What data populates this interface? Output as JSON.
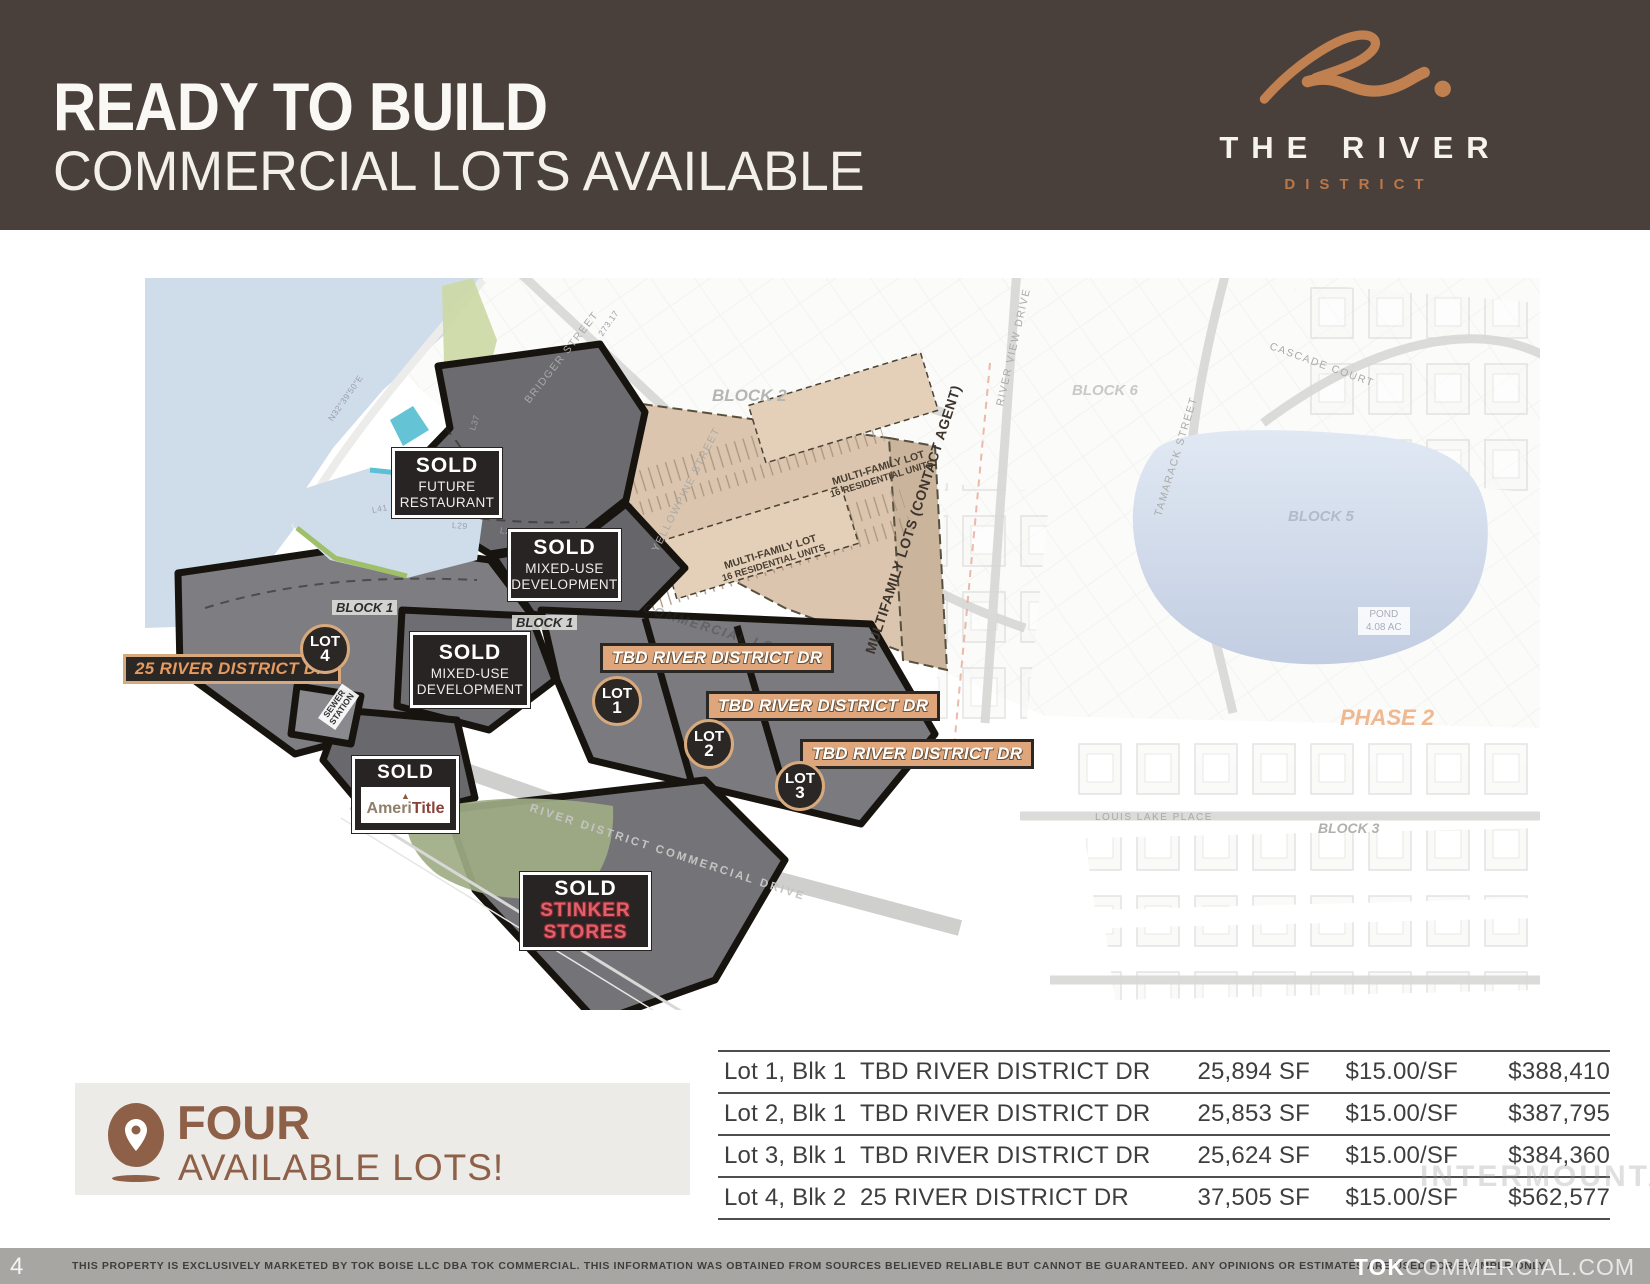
{
  "header": {
    "title_line1": "READY TO BUILD",
    "title_line2": "COMMERCIAL LOTS AVAILABLE",
    "logo_name": "THE RIVER",
    "logo_sub": "DISTRICT"
  },
  "colors": {
    "header_bg": "#493f3b",
    "copper": "#c0804f",
    "tag_tan": "#dfa67c",
    "box_dark": "#282423",
    "water": "#cfdcea",
    "brown_text": "#8d6047",
    "stinker_red": "#e2606a",
    "footer_gray": "#a8a6a3"
  },
  "map": {
    "sold_restaurant": {
      "tag": "SOLD",
      "line1": "FUTURE",
      "line2": "RESTAURANT"
    },
    "sold_mixed_upper": {
      "tag": "SOLD",
      "line1": "MIXED-USE",
      "line2": "DEVELOPMENT"
    },
    "sold_mixed_lower": {
      "tag": "SOLD",
      "line1": "MIXED-USE",
      "line2": "DEVELOPMENT"
    },
    "sold_amerititle": {
      "tag": "SOLD",
      "brand_prefix": "Ameri",
      "brand_suffix": "Title",
      "triangle_icon": "▲"
    },
    "sold_stinker": {
      "tag": "SOLD",
      "line1": "STINKER",
      "line2": "STORES"
    },
    "address_tags": [
      {
        "text": "TBD RIVER DISTRICT DR"
      },
      {
        "text": "TBD RIVER DISTRICT DR"
      },
      {
        "text": "TBD RIVER DISTRICT DR"
      },
      {
        "text": "25 RIVER DISTRICT DR"
      }
    ],
    "lot_badges": [
      {
        "label": "LOT",
        "num": "1"
      },
      {
        "label": "LOT",
        "num": "2"
      },
      {
        "label": "LOT",
        "num": "3"
      },
      {
        "label": "LOT",
        "num": "4"
      }
    ],
    "multifamily": {
      "pads": [
        {
          "line1": "MULTI-FAMILY LOT",
          "line2": "16 RESIDENTIAL UNITS"
        },
        {
          "line1": "MULTI-FAMILY LOT",
          "line2": "16 RESIDENTIAL UNITS"
        }
      ],
      "edge": "MULTIFAMILY LOTS (CONTACT AGENT)"
    },
    "blocks": {
      "block1a": "BLOCK 1",
      "block1b": "BLOCK 1",
      "block2": "BLOCK 2",
      "block3": "BLOCK 3",
      "block5": "BLOCK 5",
      "block6": "BLOCK 6"
    },
    "phase": "PHASE 2",
    "pond_line1": "POND",
    "pond_line2": "4.08 AC",
    "streets": {
      "bridger": "BRIDGER STREET",
      "riverview": "RIVER VIEW DRIVE",
      "tamarack": "TAMARACK STREET",
      "cascade": "CASCADE COURT",
      "louislake": "LOUIS LAKE PLACE",
      "yellowpine": "YELLOWPINE STREET",
      "commercial": "RIVER DISTRICT COMMERCIAL DRIVE",
      "sewer_line1": "SEWER",
      "sewer_line2": "STATION"
    },
    "ghost_label": "COMMERCIAL LOTS",
    "survey": [
      "273.17",
      "N32°39'50\"E",
      "L37",
      "L38",
      "L39",
      "L40",
      "L41",
      "L28",
      "L29"
    ]
  },
  "availability": {
    "headline": "FOUR",
    "subline": "AVAILABLE LOTS!"
  },
  "table": {
    "rows": [
      {
        "lot": "Lot 1, Blk 1",
        "address": "TBD RIVER DISTRICT DR",
        "size": "25,894 SF",
        "rate": "$15.00/SF",
        "price": "$388,410"
      },
      {
        "lot": "Lot 2, Blk 1",
        "address": "TBD RIVER DISTRICT DR",
        "size": "25,853 SF",
        "rate": "$15.00/SF",
        "price": "$387,795"
      },
      {
        "lot": "Lot 3, Blk 1",
        "address": "TBD RIVER DISTRICT DR",
        "size": "25,624 SF",
        "rate": "$15.00/SF",
        "price": "$384,360"
      },
      {
        "lot": "Lot 4, Blk 2",
        "address": "25 RIVER DISTRICT DR",
        "size": "37,505 SF",
        "rate": "$15.00/SF",
        "price": "$562,577"
      }
    ]
  },
  "watermark": "INTERMOUNTAIN",
  "footer": {
    "page_number": "4",
    "disclaimer": "THIS PROPERTY IS EXCLUSIVELY MARKETED BY TOK BOISE LLC DBA TOK COMMERCIAL. THIS INFORMATION WAS OBTAINED FROM SOURCES BELIEVED RELIABLE BUT CANNOT BE GUARANTEED. ANY OPINIONS OR ESTIMATES ARE USED FOR EXAMPLE ONLY.",
    "site_bold": "TOK",
    "site_rest": "COMMERCIAL.COM"
  }
}
